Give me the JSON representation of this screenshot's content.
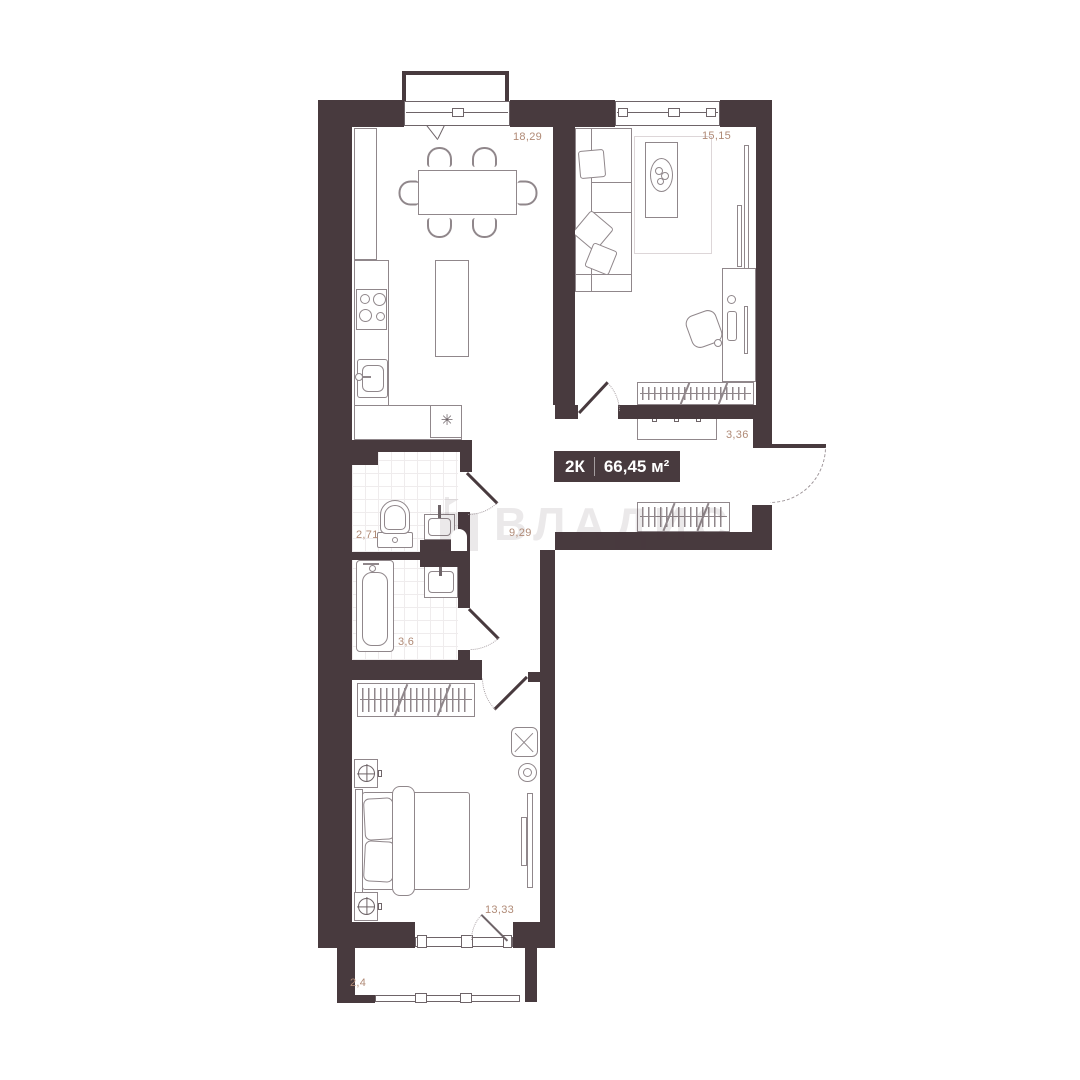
{
  "badge": {
    "rooms": "2К",
    "area": "66,45 м²"
  },
  "watermark": {
    "text": "ВЛАДИС"
  },
  "areas": {
    "kitchen": "18,29",
    "living_room": "15,15",
    "hallway": "3,36",
    "wc": "2,71",
    "corridor": "9,29",
    "bathroom": "3,6",
    "bedroom": "13,33",
    "balcony": "2,4"
  },
  "icons": {
    "fridge": "✳"
  }
}
